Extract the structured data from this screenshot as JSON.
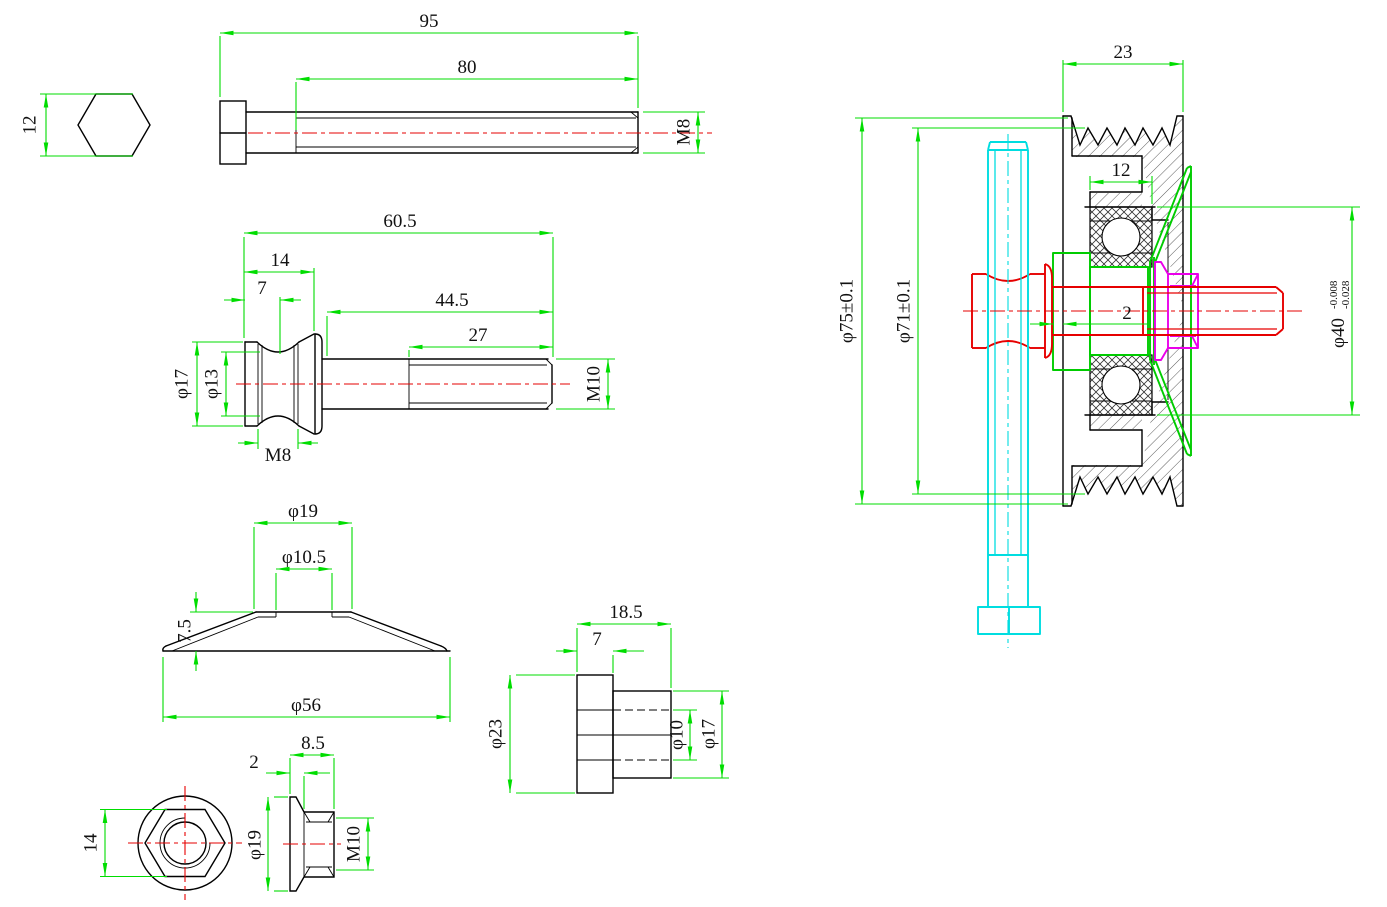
{
  "drawing": {
    "type": "CAD multi-view mechanical drawing — idler pulley assembly with fasteners",
    "colors": {
      "outline": "#000000",
      "dimension_lines": "#00dd00",
      "centerline": "#e60000",
      "part_bolt_vertical": "#00dde0",
      "part_spool_shaft": "#e60000",
      "part_flanged_nut": "#ea00ea",
      "part_bushing_washer": "#00cc00",
      "background": "#ffffff"
    },
    "views": {
      "bolt_end": {
        "across_flats": "12"
      },
      "bolt_side": {
        "total_length": "95",
        "thread_length": "80",
        "thread_spec": "M8"
      },
      "spool": {
        "total_length": "60.5",
        "head_length": "14",
        "groove_center": "7",
        "shank_length": "44.5",
        "thread_length": "27",
        "head_dia": "φ17",
        "groove_dia": "φ13",
        "cross_thread": "M8",
        "thread_spec": "M10"
      },
      "washer": {
        "top_dia": "φ19",
        "hole_dia": "φ10.5",
        "height": "7.5",
        "base_dia": "φ56"
      },
      "bushing": {
        "total_length": "18.5",
        "flange_length": "7",
        "flange_dia": "φ23",
        "bore_dia": "φ10",
        "body_dia": "φ17"
      },
      "nut_front": {
        "across_flats": "14"
      },
      "nut_side": {
        "total_width": "8.5",
        "flange_width": "2",
        "flange_dia": "φ19",
        "thread_spec": "M10"
      },
      "assembly": {
        "pulley_width": "23",
        "bearing_width": "12",
        "clearance": "2",
        "outer_dia": "φ75±0.1",
        "tip_dia": "φ71±0.1",
        "bore_dia": "φ40",
        "bore_tol_upper": "-0.008",
        "bore_tol_lower": "-0.028"
      }
    }
  }
}
